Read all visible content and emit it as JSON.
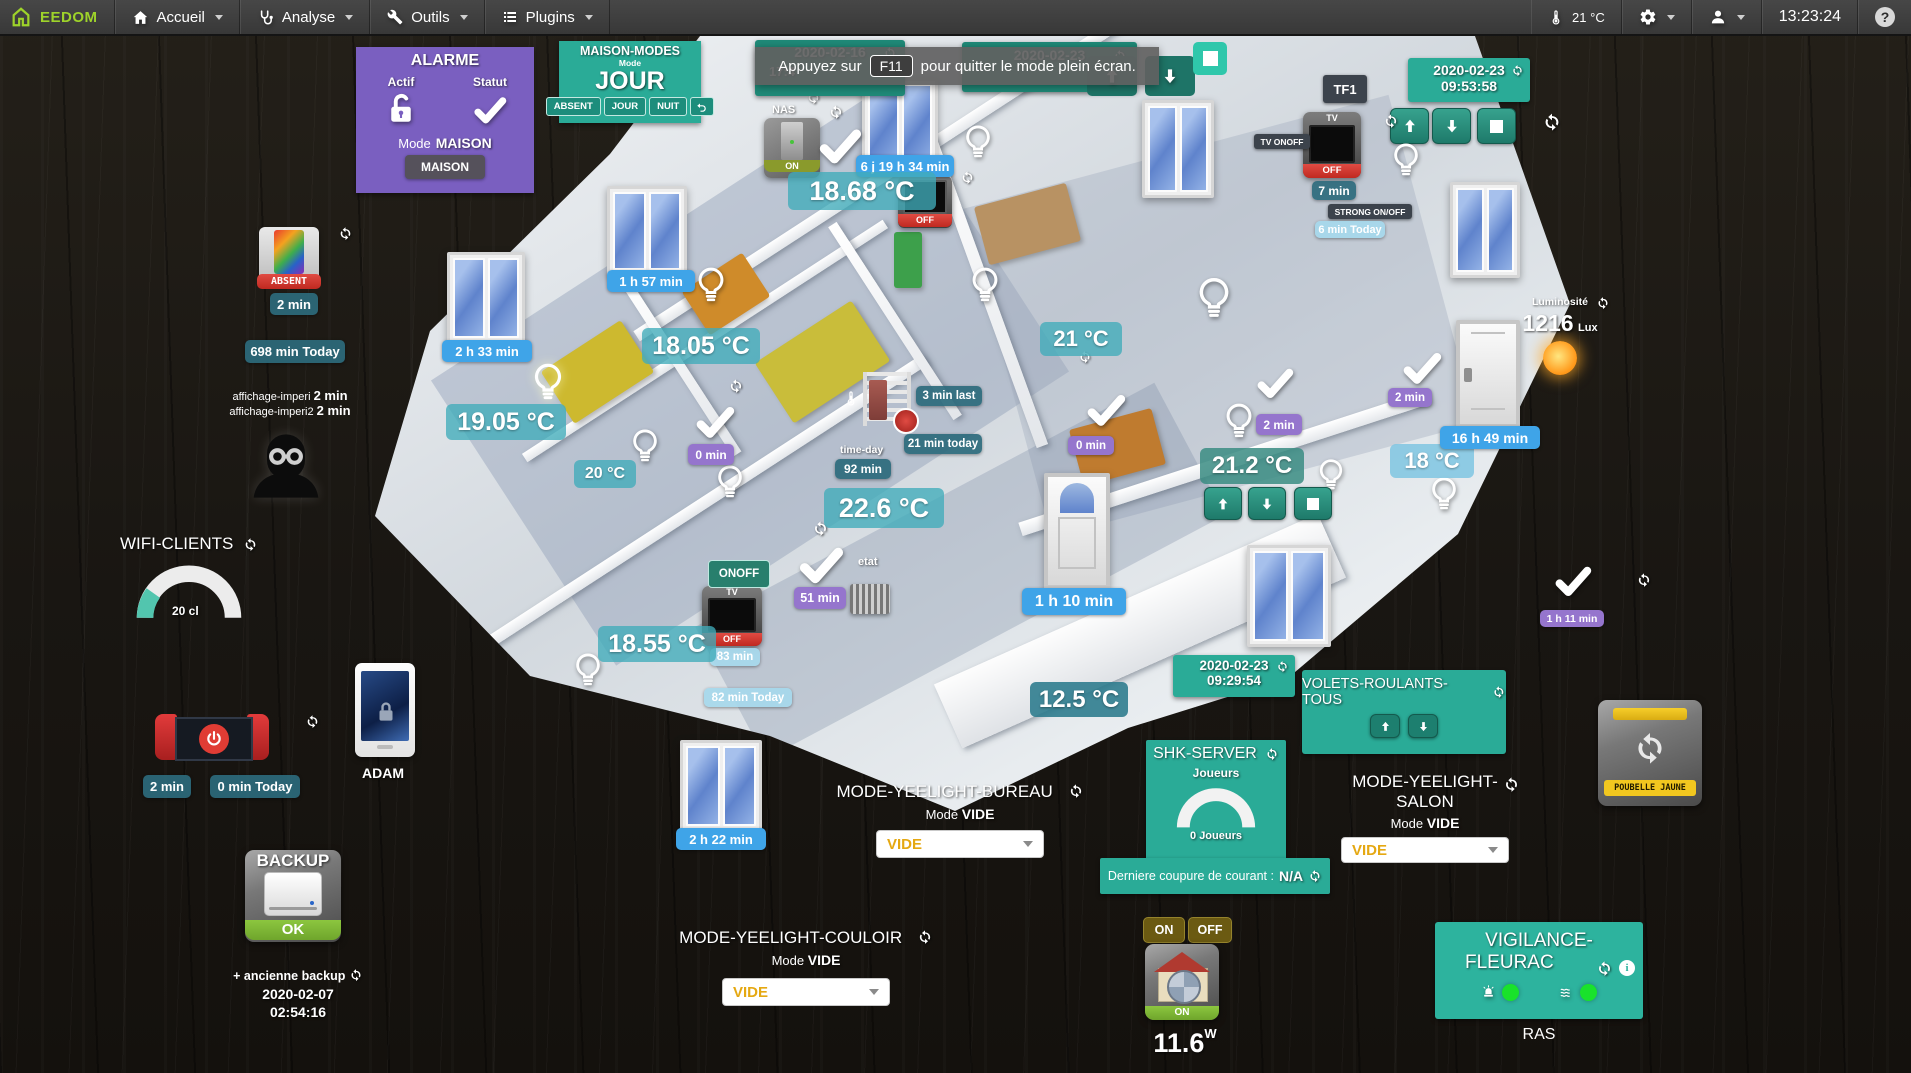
{
  "navbar": {
    "logo_text": "EEDOM",
    "menus": [
      {
        "label": "Accueil"
      },
      {
        "label": "Analyse"
      },
      {
        "label": "Outils"
      },
      {
        "label": "Plugins"
      }
    ],
    "temperature": "21 °C",
    "time": "13:23:24"
  },
  "notification": {
    "prefix": "Appuyez sur",
    "key": "F11",
    "suffix": "pour quitter le mode plein écran."
  },
  "alarme": {
    "title": "ALARME",
    "actif": "Actif",
    "statut": "Statut",
    "mode_label": "Mode",
    "mode_value": "MAISON",
    "button": "MAISON"
  },
  "maison_modes": {
    "title": "MAISON-MODES",
    "mode_label": "Mode",
    "value": "JOUR",
    "btn_absent": "ABSENT",
    "btn_jour": "JOUR",
    "btn_nuit": "NUIT"
  },
  "hidden_dates": {
    "left_date": "2020-02-16",
    "left_time": "17:4",
    "right_date": "2020-02-23"
  },
  "date_top_right": {
    "date": "2020-02-23",
    "time": "09:53:58"
  },
  "tf1": "TF1",
  "tv_right": {
    "label": "TV ONOFF",
    "title": "TV",
    "state": "OFF",
    "badge": "7 min",
    "strong_label": "STRONG ON/OFF",
    "strong_value": "6 min Today"
  },
  "tablet": {
    "state": "ABSENT",
    "badge": "2 min",
    "today": "698 min Today",
    "line1_label": "affichage-imperi",
    "line1_value": "2 min",
    "line2_label": "affichage-imperi2",
    "line2_value": "2 min"
  },
  "wifi": {
    "title": "WIFI-CLIENTS",
    "gauge_label": "20 cl"
  },
  "console": {
    "badge": "2 min",
    "today": "0 min Today"
  },
  "adam": "ADAM",
  "backup": {
    "title": "BACKUP",
    "status": "OK",
    "link": "+ ancienne backup",
    "date": "2020-02-07",
    "time": "02:54:16"
  },
  "plan": {
    "nas_label": "NAS",
    "nas_state": "ON",
    "temp_1868": "18.68 °C",
    "dur_6j": "6 j 19 h 34 min",
    "tv_mid_state": "OFF",
    "dur_157": "1 h 57 min",
    "dur_233": "2 h 33 min",
    "temp_1805": "18.05 °C",
    "temp_1905": "19.05 °C",
    "temp_20": "20 °C",
    "zero_a": "0 min",
    "zero_b": "0 min",
    "last_3": "3 min last",
    "today_21": "21 min today",
    "timeday_label": "time-day",
    "timeday_value": "92 min",
    "temp_226": "22.6 °C",
    "etat": "etat",
    "onoff": "ONOFF",
    "tv_low_title": "TV",
    "tv_low_state": "OFF",
    "min_83": "83 min",
    "today_82": "82 min Today",
    "temp_1855": "18.55 °C",
    "min_51": "51 min",
    "dur_110": "1 h 10 min",
    "temp_125": "12.5 °C",
    "dur_222": "2 h 22 min",
    "temp_21": "21 °C",
    "temp_212": "21.2 °C",
    "min_2a": "2 min",
    "min_2b": "2 min",
    "temp_18": "18 °C",
    "dur_1649": "16 h 49 min",
    "dur_111": "1 h 11 min"
  },
  "luminosite": {
    "label": "Luminosité",
    "value": "1216",
    "unit": "Lux"
  },
  "date_mid": {
    "date": "2020-02-23",
    "time": "09:29:54"
  },
  "volets": {
    "title": "VOLETS-ROULANTS-TOUS"
  },
  "shk": {
    "title": "SHK-SERVER",
    "players_label": "Joueurs",
    "players_value": "0 Joueurs",
    "footer_label": "Derniere coupure de courant :",
    "footer_value": "N/A"
  },
  "yeelight_bureau": {
    "title": "MODE-YEELIGHT-BUREAU",
    "mode_label": "Mode",
    "mode_value": "VIDE",
    "select": "VIDE"
  },
  "yeelight_couloir": {
    "title": "MODE-YEELIGHT-COULOIR",
    "mode_label": "Mode",
    "mode_value": "VIDE",
    "select": "VIDE"
  },
  "yeelight_salon": {
    "title_1": "MODE-YEELIGHT-",
    "title_2": "SALON",
    "mode_label": "Mode",
    "mode_value": "VIDE",
    "select": "VIDE"
  },
  "power": {
    "on": "ON",
    "off": "OFF",
    "state": "ON",
    "value": "11.6",
    "unit": "W"
  },
  "vigilance": {
    "title_1": "VIGILANCE-",
    "title_2": "FLEURAC",
    "status": "RAS"
  },
  "poubelle": "POUBELLE JAUNE",
  "colors": {
    "teal": "#2aab97",
    "purple": "#7a5fc0",
    "blue_badge": "#3fa4e8",
    "lavender": "#9575cd",
    "dark_teal": "#2d6a7c",
    "light_blue": "#a6d8ec",
    "red": "#d63a35",
    "green": "#7cb53a",
    "gold": "#6b5a12"
  }
}
